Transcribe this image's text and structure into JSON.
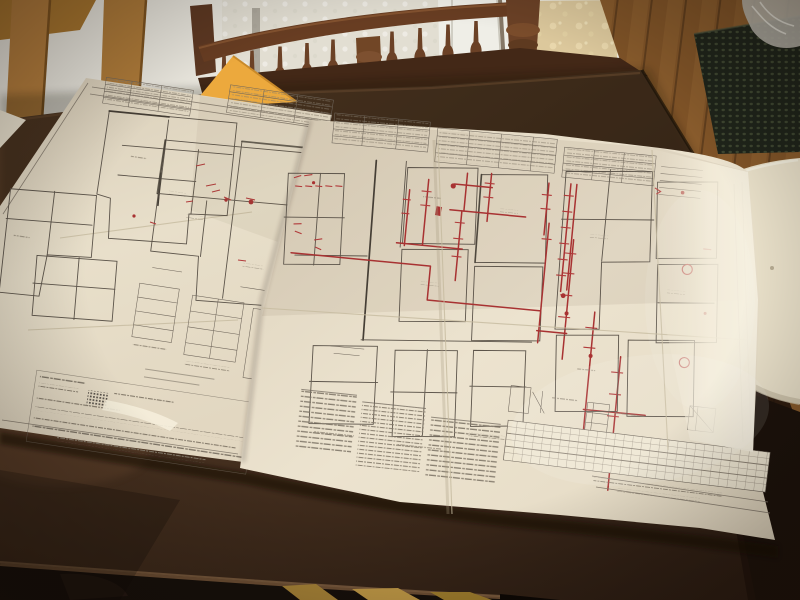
{
  "meta": {
    "domain": "Natural-Image",
    "description": "Flash-lit night photograph of architectural blueprint sheets, marked up in red, spread across a dark wooden dining table in a dining room"
  },
  "scene": {
    "setting": "dim dining room, camera looking down across the table",
    "subject": "two large architect's floor-plan sheets with dense fine print and hand-drawn red markup; printed text too small to be legible",
    "objects": [
      {
        "name": "dining-table",
        "material": "dark stained walnut wood"
      },
      {
        "name": "blueprint-sheet-left",
        "content": "floor-plan fragments, title tables, spec text rows, dithered hatch block",
        "markup": "small scattered red annotations"
      },
      {
        "name": "blueprint-sheet-large",
        "content": "title strip, several floor plans, detail sketches, long schedule grid",
        "markup": "heavy red lines tracing walls, red ticks and circled notes",
        "right_edge": "curled up catching the flash"
      },
      {
        "name": "paper-corner-underneath",
        "position": "far left edge"
      },
      {
        "name": "manila-envelope",
        "position": "peeking from under papers, top centre"
      },
      {
        "name": "spindle-back-chair",
        "material": "dark wood",
        "position": "behind table, centre"
      },
      {
        "name": "ladder-back-chair",
        "material": "light oak",
        "position": "top left"
      },
      {
        "name": "cream-chair-seat",
        "position": "right of table"
      },
      {
        "name": "white-wall-paneling",
        "texture": "embossed"
      },
      {
        "name": "white-door",
        "position": "top centre-right"
      },
      {
        "name": "wallpaper-panel",
        "pattern": "faint beige floral"
      },
      {
        "name": "hardwood-floor",
        "position": "top right corner and under table"
      },
      {
        "name": "dark-doormat",
        "texture": "rows of nubs",
        "position": "on floor, top right"
      },
      {
        "name": "plastic-bag",
        "position": "top right corner"
      }
    ],
    "annotations": {
      "red_markup_color": "#a83232",
      "style": "hand-drawn pen tracing walls/runs with short tick marks, two circled notes on right plan"
    }
  },
  "colors": {
    "wall": "#e8e5dc",
    "wall_mid": "#e2ded2",
    "door": "#efeee7",
    "wallpaper": "#dcc89c",
    "floor": "#8f5e2d",
    "mat": "#1f241a",
    "bag": "#b6b2a9",
    "chair_dark": "#683d22",
    "chair_dark_low": "#432817",
    "chair_light": "#b37d3d",
    "chair_cream": "#eae1ca",
    "table": "#4a3322",
    "table_dark": "#241710",
    "under_table": "#17100b",
    "floor_slat": "#b08a3a",
    "paper_left": "#e6dcc7",
    "paper_big": "#ece3cf",
    "paper_corner": "#e9e1ce",
    "envelope": "#eca93d"
  }
}
